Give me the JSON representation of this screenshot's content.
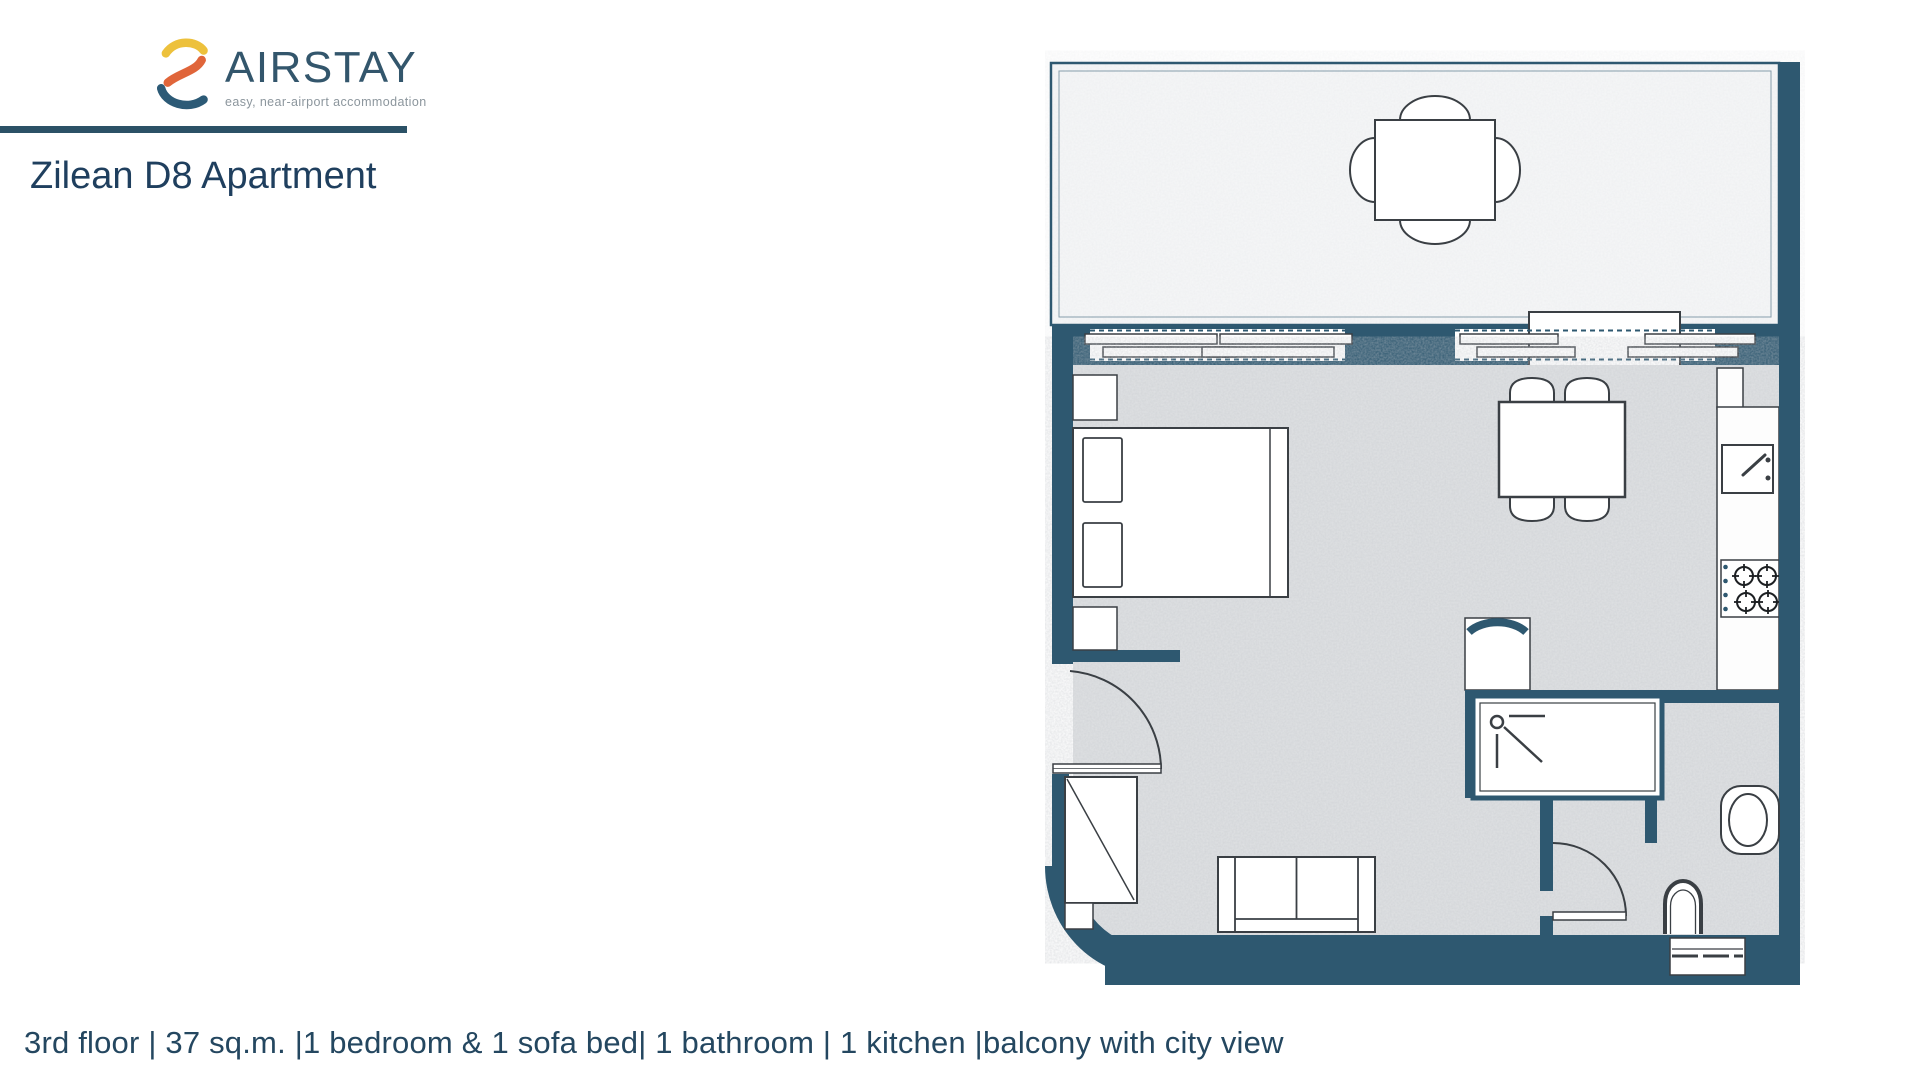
{
  "brand": {
    "name": "AIRSTAY",
    "tagline": "easy, near-airport accommodation",
    "logo_colors": {
      "top": "#edc13c",
      "middle": "#e0653a",
      "bottom": "#2c5a76"
    }
  },
  "page": {
    "title": "Zilean D8 Apartment"
  },
  "features": {
    "line": "3rd floor | 37 sq.m. |1 bedroom & 1 sofa bed| 1 bathroom | 1 kitchen |balcony with city view",
    "items": [
      "3rd floor",
      "37 sq.m.",
      "1 bedroom & 1 sofa bed",
      "1 bathroom",
      "1 kitchen",
      "balcony with city view"
    ]
  },
  "floorplan": {
    "rooms": [
      "balcony",
      "living-bedroom",
      "kitchen",
      "bathroom"
    ],
    "furniture": [
      "outdoor-table-with-chairs",
      "double-bed",
      "nightstands",
      "dining-table-with-chairs",
      "sofa-bed",
      "kitchen-sink",
      "stove-4-burners",
      "fridge",
      "shower",
      "toilet",
      "washbasin",
      "washing-machine",
      "wardrobe",
      "entrance-door",
      "bathroom-door",
      "sliding-balcony-doors"
    ],
    "colors": {
      "wall": "#2e5870",
      "floor": "#e0e2e4",
      "balcony_floor": "#f6f7f8",
      "outline": "#3a3f44"
    }
  }
}
